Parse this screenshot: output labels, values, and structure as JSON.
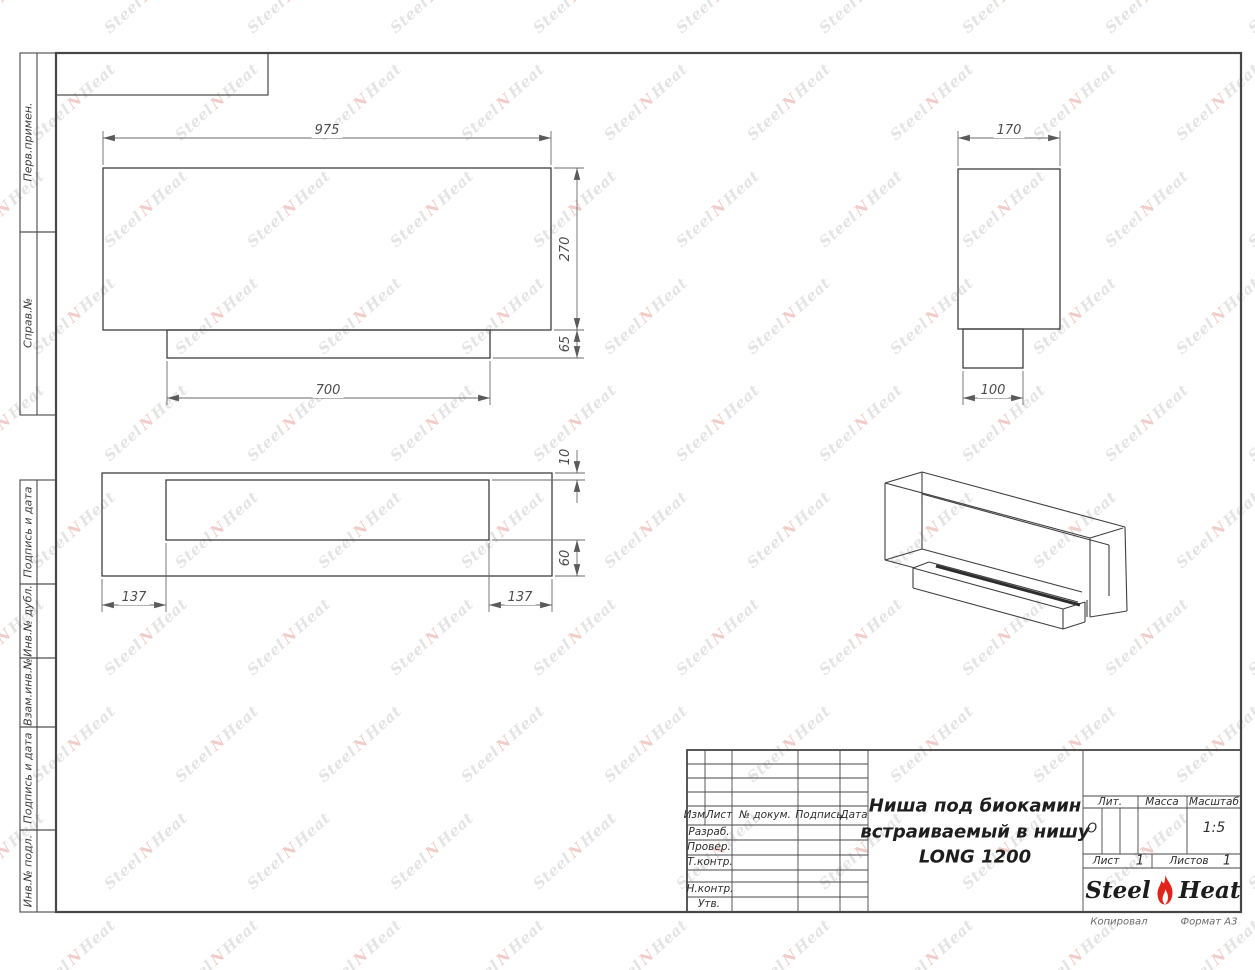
{
  "sheet": {
    "copied_label": "Копировал",
    "format_label": "Формат А3"
  },
  "watermark": {
    "left": "Steel",
    "mark_icon": "flame-icon",
    "right": "Heat"
  },
  "margin_labels": [
    {
      "label": "Перв.примен."
    },
    {
      "label": "Справ.№"
    },
    {
      "label": "Подпись и дата"
    },
    {
      "label": "Инв.№ дубл."
    },
    {
      "label": "Взам.инв.№"
    },
    {
      "label": "Подпись и дата"
    },
    {
      "label": "Инв.№ подл."
    }
  ],
  "views": {
    "front": {
      "dim_width": "975",
      "dim_height": "270",
      "dim_base_height": "65",
      "dim_base_width": "700"
    },
    "side": {
      "dim_width": "170",
      "dim_base_width": "100"
    },
    "top": {
      "dim_top_inset": "10",
      "dim_bottom_inset": "60",
      "dim_left_inset": "137",
      "dim_right_inset": "137"
    }
  },
  "title_block": {
    "header": {
      "izm": "Изм.",
      "list": "Лист",
      "doc": "№ докум.",
      "sign": "Подпись",
      "date": "Дата"
    },
    "rows": [
      {
        "label": "Разраб."
      },
      {
        "label": "Провер."
      },
      {
        "label": "Т.контр."
      },
      {
        "label": ""
      },
      {
        "label": "Н.контр."
      },
      {
        "label": "Утв."
      }
    ],
    "title_line1": "Ниша под биокамин",
    "title_line2": "встраиваемый в нишу",
    "title_line3": "LONG 1200",
    "lit_label": "Лит.",
    "lit_value": "О",
    "mass_label": "Масса",
    "mass_value": "",
    "scale_label": "Масштаб",
    "scale_value": "1:5",
    "sheet_label": "Лист",
    "sheet_value": "1",
    "sheets_label": "Листов",
    "sheets_value": "1",
    "logo_left": "Steel",
    "logo_right": "Heat",
    "flame_color": "#e2231a"
  }
}
